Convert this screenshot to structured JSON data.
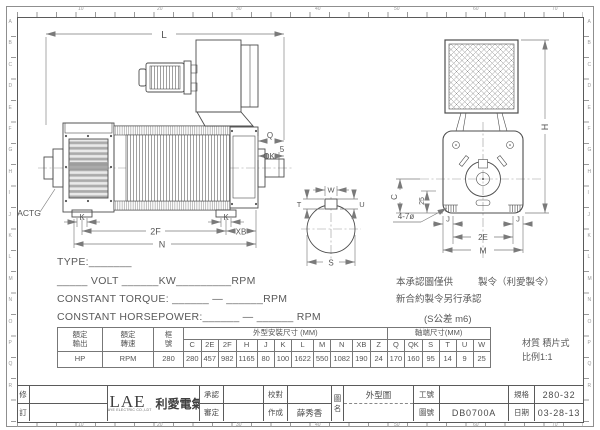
{
  "sheet": {
    "bg": "#ffffff",
    "line": "#4d4d4d",
    "dim_color": "#7a7a7a",
    "text_color": "#555555"
  },
  "ruler": {
    "side_letters": [
      "A",
      "B",
      "C",
      "D",
      "E",
      "F",
      "G",
      "H",
      "I",
      "J",
      "K",
      "L",
      "M",
      "N",
      "O",
      "P",
      "Q",
      "R"
    ],
    "numbers": [
      "10",
      "20",
      "30",
      "40",
      "50",
      "60",
      "70"
    ]
  },
  "drawing": {
    "labels": {
      "L": "L",
      "Q": "Q",
      "OK": "OK",
      "five": "5",
      "K": "K",
      "F2": "2F",
      "XB": "XB",
      "N": "N",
      "ACTG": "ACTG",
      "W": "W",
      "T": "T",
      "U": "U",
      "S": "S",
      "holes": "4-7ø",
      "H": "H",
      "C": "C",
      "n25": "25",
      "J": "J",
      "E2": "2E",
      "M": "M"
    }
  },
  "specs": {
    "type_line": "TYPE:_______",
    "volt_line": "_____ VOLT ______KW_________RPM",
    "torque_line": "CONSTANT TORQUE: ______ — ______RPM",
    "hp_line": "CONSTANT HORSEPOWER:______ — ______ RPM"
  },
  "notes": {
    "line1a": "本承認圖僅供",
    "line1b": "製令（利愛製令）",
    "line2": "新合約製令另行承認",
    "line3": "(S公差 m6)",
    "material": "材質 積片式",
    "scale": "比例1:1"
  },
  "table": {
    "rated_output_label": "額定輸出",
    "rated_speed_label": "額定轉速",
    "frame_label": "框號",
    "dim_group": "外型安裝尺寸 (MM)",
    "shaft_group": "軸端尺寸(MM)",
    "rated_output": "HP",
    "rated_speed": "RPM",
    "frame": "280",
    "dims": [
      {
        "k": "C",
        "v": "280"
      },
      {
        "k": "2E",
        "v": "457"
      },
      {
        "k": "2F",
        "v": "982"
      },
      {
        "k": "H",
        "v": "1165"
      },
      {
        "k": "J",
        "v": "80"
      },
      {
        "k": "K",
        "v": "100"
      },
      {
        "k": "L",
        "v": "1622"
      },
      {
        "k": "M",
        "v": "550"
      },
      {
        "k": "N",
        "v": "1082"
      },
      {
        "k": "XB",
        "v": "190"
      },
      {
        "k": "Z",
        "v": "24"
      },
      {
        "k": "Q",
        "v": "170"
      },
      {
        "k": "QK",
        "v": "160"
      },
      {
        "k": "S",
        "v": "95"
      },
      {
        "k": "T",
        "v": "14"
      },
      {
        "k": "U",
        "v": "9"
      },
      {
        "k": "W",
        "v": "25"
      }
    ]
  },
  "titleblock": {
    "rev_top": "修",
    "rev_bottom": "訂",
    "logo": "LAE",
    "logo_sub": "LI AYE ELECTRIC CO.,LDT",
    "company": "利愛電氣",
    "approve": "承認",
    "review": "審定",
    "check": "校對",
    "drawn": "作成",
    "drawn_by": "薛秀香",
    "dwg_name_v1": "圖",
    "dwg_name_v2": "名",
    "dwg_name": "外型圖",
    "work_no_label": "工號",
    "work_no": "",
    "dwg_no_label": "圖號",
    "dwg_no": "DB0700A",
    "spec_label": "規格",
    "spec": "280-32",
    "date_label": "日期",
    "date": "03-28-13"
  }
}
